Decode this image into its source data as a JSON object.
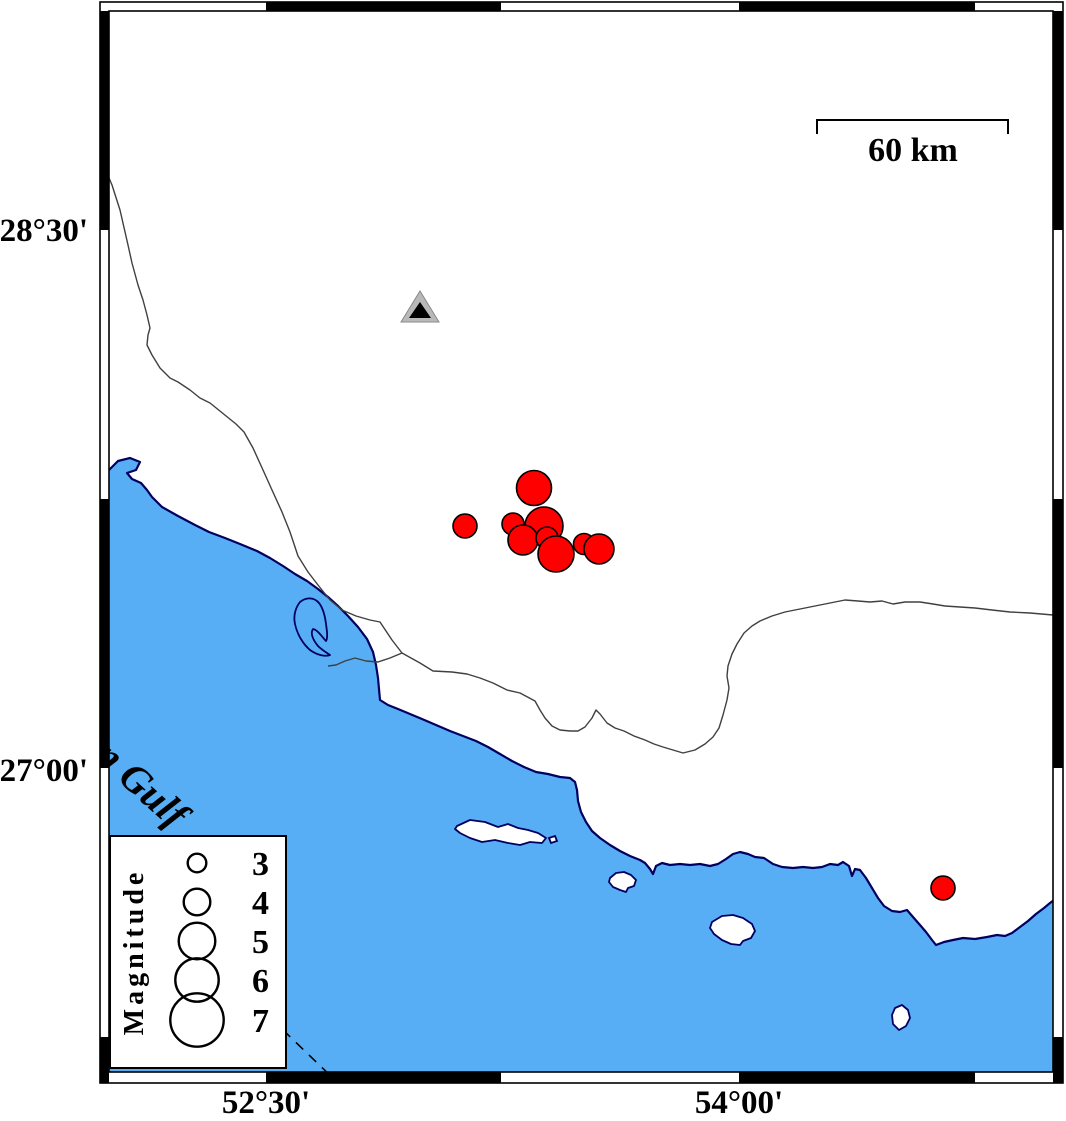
{
  "map": {
    "axis": {
      "lat_labels": [
        {
          "text": "28°30'",
          "y": 230
        },
        {
          "text": "27°00'",
          "y": 770
        }
      ],
      "lon_labels": [
        {
          "text": "52°30'",
          "x": 266
        },
        {
          "text": "54°00'",
          "x": 739
        }
      ]
    },
    "scale_bar": {
      "label": "60 km"
    },
    "water_label": "Persian Gulf",
    "legend": {
      "title": "Magnitude",
      "entries": [
        {
          "label": "3",
          "r": 9.3,
          "cy": 863
        },
        {
          "label": "4",
          "r": 13.3,
          "cy": 902
        },
        {
          "label": "5",
          "r": 18.3,
          "cy": 941
        },
        {
          "label": "6",
          "r": 21.7,
          "cy": 980
        },
        {
          "label": "7",
          "r": 26.7,
          "cy": 1020
        }
      ],
      "circle_cx": 197,
      "number_x": 252
    },
    "earthquakes": [
      {
        "x": 513,
        "y": 524,
        "r": 11
      },
      {
        "x": 544,
        "y": 526,
        "r": 19
      },
      {
        "x": 523,
        "y": 540,
        "r": 15
      },
      {
        "x": 534,
        "y": 488,
        "r": 17.5
      },
      {
        "x": 547,
        "y": 538,
        "r": 11
      },
      {
        "x": 584,
        "y": 544,
        "r": 10.5
      },
      {
        "x": 599,
        "y": 549,
        "r": 15
      },
      {
        "x": 556,
        "y": 554,
        "r": 18
      },
      {
        "x": 465,
        "y": 526,
        "r": 12
      },
      {
        "x": 943,
        "y": 888,
        "r": 12
      }
    ],
    "station": {
      "x": 420,
      "y": 308
    },
    "colors": {
      "sea": "#57AEF5",
      "coast": "#000060",
      "land": "#FFFFFF",
      "earthquake": "#FF0000",
      "earthquake_outline": "#000000",
      "station_gray": "#B9B9B9",
      "station_core": "#000000",
      "line": "#404040",
      "frame": "#000000"
    }
  }
}
